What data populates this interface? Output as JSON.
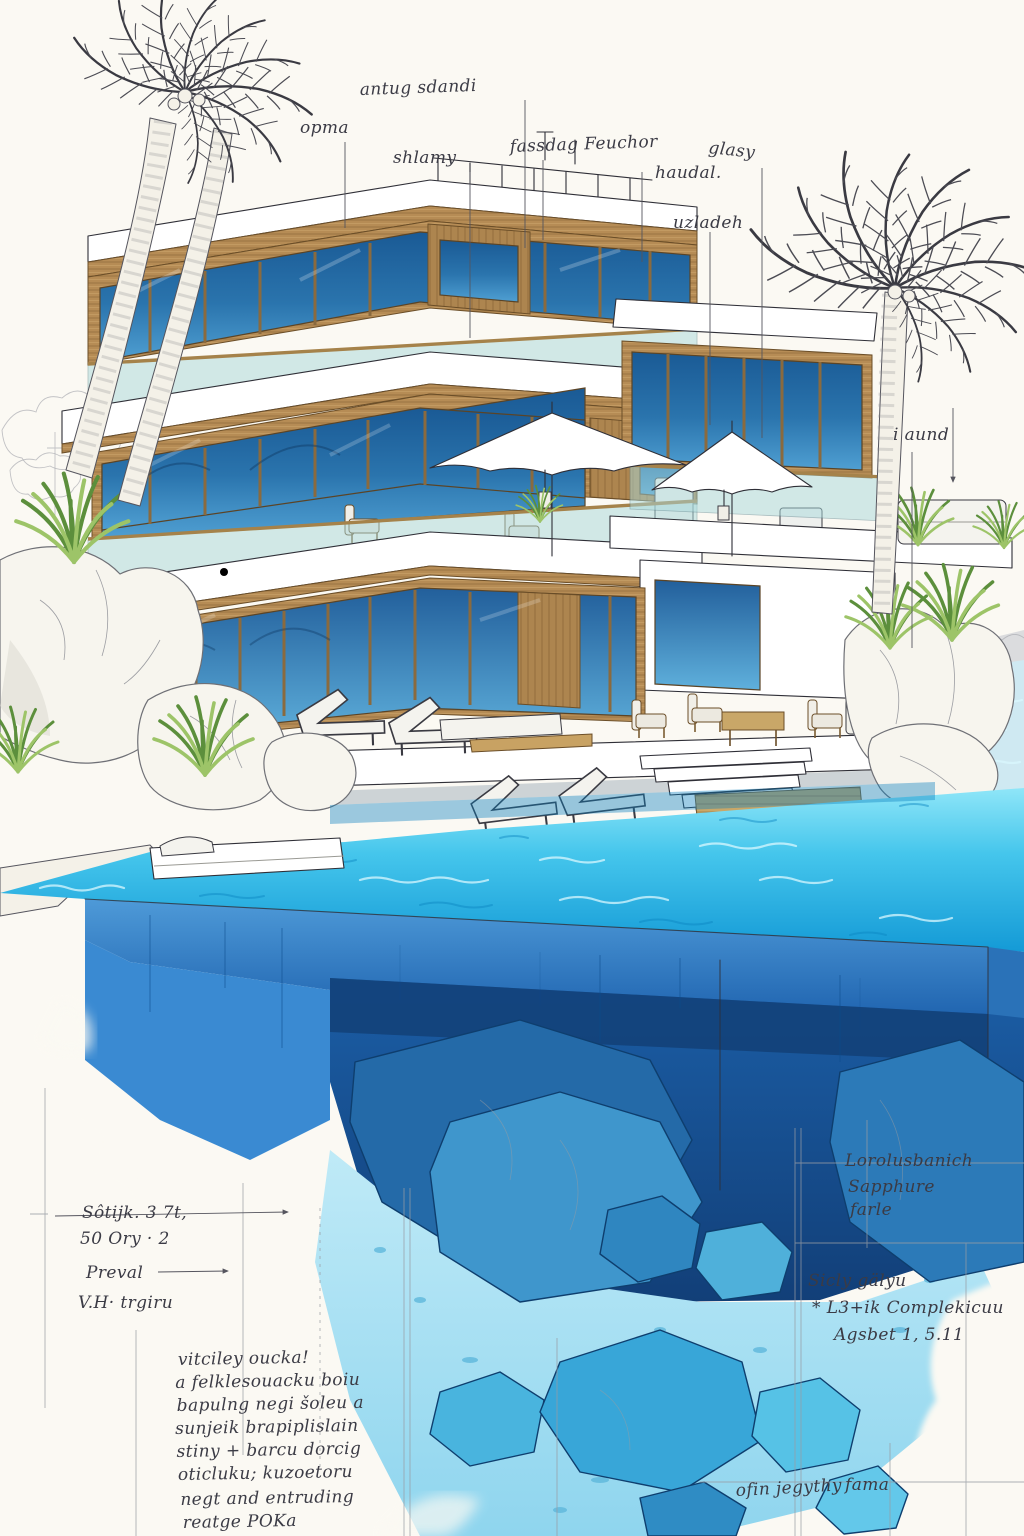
{
  "artwork": {
    "palette": {
      "paper": "#fbf9f3",
      "ink": "#2f2f37",
      "wood": "#b68c55",
      "window_blue": "#2a74ad",
      "glass_rail": "#a9d9db",
      "water_surface": "#2fbde8",
      "pool_wall_blue": "#2d7cc4",
      "deep_water": "#15508e",
      "underwater_rock": "#3f96cc",
      "sediment": "#a5e0f2",
      "foliage": "#6f9c45"
    }
  },
  "annotations": {
    "roof_label": "antug sdandi",
    "upper_left_label": "opma",
    "upper_left_label2": "shlamy",
    "upper_center_label": "fassdag Feuchor",
    "upper_right_label_a": "glasy",
    "upper_right_label_b": "haudal.",
    "upper_right_label_c": "uzladeh",
    "right_side_label": "i aund",
    "left_dim_line1": "Sôtijk. 3 7t,",
    "left_dim_line2": "50 Ory · 2",
    "left_label1": "Preval",
    "left_label2": "V.H· trgiru",
    "note_lines": [
      "vitciley oucka!",
      "a felklesouacku boiu",
      "bapulng negi šoleu a",
      "sunjeik brapiplislain",
      "stiny + barcu dorcig",
      "oticluku; kuzoetoru",
      "negt and entruding",
      "reatge POKa"
    ],
    "deep_note_lines": [
      "Lorolusbanich",
      "Sapphure",
      "farle"
    ],
    "lower_note_lines": [
      "Sicly gälyu",
      "* L3+ik Complekicuu",
      "Agsbet 1, 5.11"
    ],
    "bottom_note_a": "ofin jegythy",
    "bottom_note_b": "fama"
  }
}
